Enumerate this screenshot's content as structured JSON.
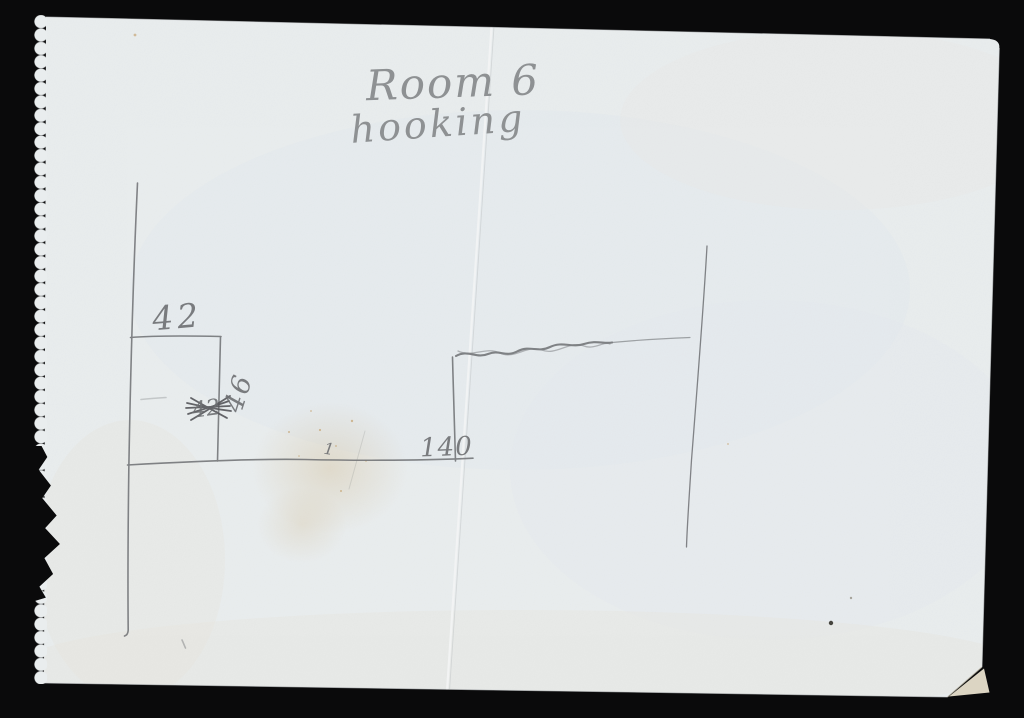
{
  "scan": {
    "background_color": "#0a0a0b",
    "paper_color": "#e9edee",
    "pencil_color": "#6e7073",
    "handwriting_color": "#8e9193",
    "stain_color": "#b98a45",
    "heading": {
      "line1": "Room 6",
      "line2": "hooking"
    },
    "labels": {
      "top_width": "42",
      "crossed_out": "42",
      "corrected_height": "46",
      "bottom_length": "140",
      "tick": "1"
    }
  }
}
